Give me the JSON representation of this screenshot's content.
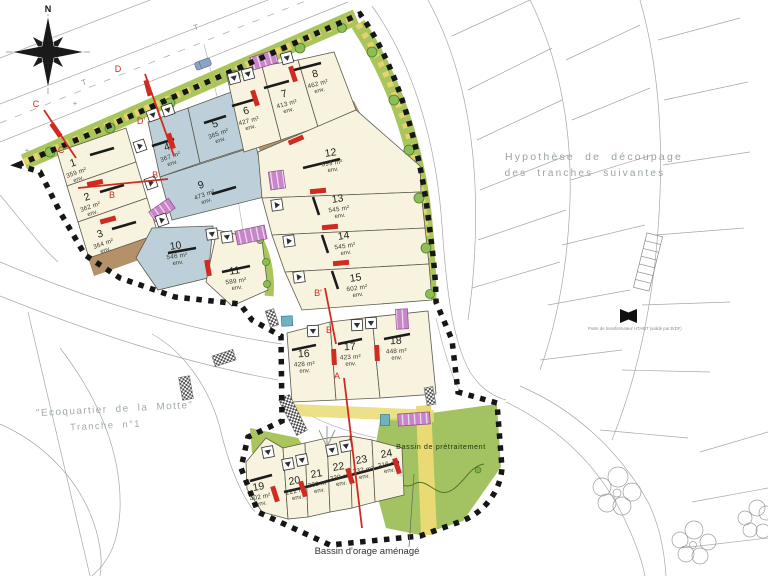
{
  "colors": {
    "c": "#f7f3df",
    "b": "#bdd0da",
    "verge": "#a9c55c",
    "hedge": "#e6d26e",
    "tree": "#8cbe53",
    "tree_stroke": "#517f2c",
    "bassin": "#a3c261",
    "path_yellow": "#e9da74",
    "brown": "#b59169",
    "purple": "#c985c9",
    "red": "#cf2b20",
    "boundary": "#161616",
    "future_gray": "#a7a7a7",
    "gray_label": "#9aa4a2"
  },
  "compass": {
    "label": "N"
  },
  "env_label": "env.",
  "annotations": {
    "hypothese_line1": "Hypothèse de découpage",
    "hypothese_line2": "des tranches suivantes",
    "ecoquartier_line1": "\"Ecoquartier de la Motte\"",
    "ecoquartier_line2": "Tranche n°1",
    "bassin_pretraitement": "Bassin de prétraitement",
    "bassin_orage": "Bassin d'orage aménagé",
    "transformer_note": "Poste de transformateur HTA/BT (validé par ErDF)",
    "utility_t1": "T",
    "utility_t2": "T",
    "cross1": "+",
    "cross2": "+"
  },
  "section_labels": [
    {
      "t": "C",
      "x": 36,
      "y": 107
    },
    {
      "t": "C'",
      "x": 62,
      "y": 153
    },
    {
      "t": "D",
      "x": 118,
      "y": 72
    },
    {
      "t": "D'",
      "x": 141,
      "y": 124
    },
    {
      "t": "B",
      "x": 112,
      "y": 198
    },
    {
      "t": "B'",
      "x": 156,
      "y": 178
    },
    {
      "t": "B'",
      "x": 318,
      "y": 296
    },
    {
      "t": "B",
      "x": 329,
      "y": 333
    },
    {
      "t": "A",
      "x": 337,
      "y": 379
    }
  ],
  "lots": [
    {
      "num": "1",
      "area": "359 m²",
      "type": "c",
      "poly": "57,152 126,128 136,162 67,186",
      "cx": 74,
      "cy": 166,
      "rot": -19,
      "bar": [
        90,
        155,
        114,
        148
      ]
    },
    {
      "num": "2",
      "area": "362 m²",
      "type": "c",
      "poly": "67,186 136,162 147,198 78,222",
      "cx": 88,
      "cy": 200,
      "rot": -19,
      "bar": [
        100,
        192,
        124,
        185
      ]
    },
    {
      "num": "3",
      "area": "364 m²",
      "type": "c",
      "poly": "78,222 147,198 158,234 89,258",
      "cx": 101,
      "cy": 237,
      "rot": -19,
      "bar": [
        112,
        229,
        136,
        222
      ]
    },
    {
      "num": "4",
      "area": "367 m²",
      "type": "b",
      "poly": "148,122 188,108 200,163 160,177",
      "cx": 168,
      "cy": 150,
      "rot": -19,
      "bar": [
        152,
        146,
        174,
        139
      ]
    },
    {
      "num": "5",
      "area": "365 m²",
      "type": "b",
      "poly": "188,108 242,88 256,145 200,163",
      "cx": 216,
      "cy": 127,
      "rot": -19,
      "bar": [
        204,
        123,
        226,
        116
      ]
    },
    {
      "num": "9",
      "area": "473 m²",
      "type": "b",
      "poly": "160,177 256,146 268,196 172,220",
      "cx": 202,
      "cy": 188,
      "rot": -19,
      "bar": [
        212,
        194,
        236,
        187
      ]
    },
    {
      "num": "10",
      "area": "546 m²",
      "type": "b",
      "poly": "152,228 213,226 208,278 158,290 136,258",
      "cx": 176,
      "cy": 249,
      "rot": -8,
      "bar": [
        168,
        253,
        196,
        248
      ]
    },
    {
      "num": "11",
      "area": "589 m²",
      "type": "c",
      "poly": "217,230 262,240 268,290 232,306 206,282",
      "cx": 235,
      "cy": 274,
      "rot": -8,
      "bar": [
        222,
        272,
        250,
        266
      ]
    },
    {
      "num": "6",
      "area": "427 m²",
      "type": "c",
      "poly": "226,72 262,66 281,140 244,152",
      "cx": 247,
      "cy": 114,
      "rot": -15,
      "bar": [
        232,
        106,
        256,
        99
      ]
    },
    {
      "num": "7",
      "area": "413 m²",
      "type": "c",
      "poly": "262,66 298,60 318,127 281,140",
      "cx": 285,
      "cy": 97,
      "rot": -15,
      "bar": [
        264,
        88,
        289,
        81
      ]
    },
    {
      "num": "8",
      "area": "462 m²",
      "type": "c",
      "poly": "298,60 334,52 356,110 318,127",
      "cx": 316,
      "cy": 77,
      "rot": -15,
      "bar": [
        294,
        70,
        321,
        63
      ]
    },
    {
      "num": "12",
      "area": "599 m²",
      "type": "c",
      "poly": "258,152 356,110 420,166 421,192 262,198",
      "cx": 331,
      "cy": 156,
      "rot": -8,
      "bar": [
        303,
        168,
        340,
        159
      ]
    },
    {
      "num": "13",
      "area": "545 m²",
      "type": "c",
      "poly": "262,198 421,192 425,228 272,235",
      "cx": 338,
      "cy": 202,
      "rot": -8,
      "bar": [
        313,
        197,
        319,
        215
      ]
    },
    {
      "num": "14",
      "area": "545 m²",
      "type": "c",
      "poly": "272,235 425,228 429,264 285,272",
      "cx": 344,
      "cy": 239,
      "rot": -8,
      "bar": [
        322,
        235,
        328,
        253
      ]
    },
    {
      "num": "15",
      "area": "602 m²",
      "type": "c",
      "poly": "285,272 429,264 432,300 302,310",
      "cx": 356,
      "cy": 281,
      "rot": -8,
      "bar": [
        332,
        271,
        338,
        289
      ]
    },
    {
      "num": "16",
      "area": "428 m²",
      "type": "c",
      "poly": "287,333 330,322 336,400 292,402",
      "cx": 304,
      "cy": 357,
      "rot": -3,
      "bar": [
        292,
        350,
        316,
        345
      ]
    },
    {
      "num": "17",
      "area": "423 m²",
      "type": "c",
      "poly": "330,322 372,317 380,398 336,400",
      "cx": 350,
      "cy": 350,
      "rot": -3,
      "bar": [
        338,
        344,
        362,
        339
      ]
    },
    {
      "num": "18",
      "area": "448 m²",
      "type": "c",
      "poly": "372,317 428,311 436,394 380,398",
      "cx": 396,
      "cy": 344,
      "rot": -3,
      "bar": [
        384,
        339,
        410,
        334
      ]
    },
    {
      "num": "19",
      "area": "402 m²",
      "type": "c",
      "poly": "246,462 266,438 283,448 288,519 262,512 247,489",
      "cx": 259,
      "cy": 490,
      "rot": -10,
      "bar": [
        250,
        481,
        272,
        475
      ]
    },
    {
      "num": "20",
      "area": "222 m²",
      "type": "c",
      "poly": "283,448 305,443 308,517 288,519",
      "cx": 295,
      "cy": 484,
      "rot": -10,
      "bar": [
        284,
        492,
        306,
        487
      ]
    },
    {
      "num": "21",
      "area": "230 m²",
      "type": "c",
      "poly": "305,443 327,438 330,512 308,517",
      "cx": 317,
      "cy": 477,
      "rot": -10,
      "bar": [
        306,
        487,
        328,
        481
      ]
    },
    {
      "num": "22",
      "area": "230 m²",
      "type": "c",
      "poly": "327,438 350,436 352,508 330,512",
      "cx": 339,
      "cy": 470,
      "rot": -10,
      "bar": [
        328,
        481,
        351,
        475
      ]
    },
    {
      "num": "23",
      "area": "232 m²",
      "type": "c",
      "poly": "350,436 372,440 375,502 352,508",
      "cx": 362,
      "cy": 463,
      "rot": -10,
      "bar": [
        351,
        475,
        374,
        469
      ]
    },
    {
      "num": "24",
      "area": "316 m²",
      "type": "c",
      "poly": "372,440 402,448 404,495 375,502",
      "cx": 387,
      "cy": 457,
      "rot": -10,
      "bar": [
        374,
        469,
        399,
        462
      ]
    }
  ],
  "markers": [
    {
      "x": 140,
      "y": 146,
      "rot": -19,
      "dir": "right"
    },
    {
      "x": 151,
      "y": 183,
      "rot": -19,
      "dir": "right"
    },
    {
      "x": 162,
      "y": 220,
      "rot": -19,
      "dir": "right"
    },
    {
      "x": 153,
      "y": 115,
      "rot": -19,
      "dir": "down"
    },
    {
      "x": 168,
      "y": 110,
      "rot": -19,
      "dir": "down"
    },
    {
      "x": 212,
      "y": 234,
      "rot": -8,
      "dir": "down"
    },
    {
      "x": 227,
      "y": 237,
      "rot": -8,
      "dir": "down"
    },
    {
      "x": 234,
      "y": 78,
      "rot": -15,
      "dir": "down"
    },
    {
      "x": 248,
      "y": 74,
      "rot": -15,
      "dir": "down"
    },
    {
      "x": 287,
      "y": 58,
      "rot": -15,
      "dir": "down"
    },
    {
      "x": 277,
      "y": 205,
      "rot": -8,
      "dir": "right"
    },
    {
      "x": 289,
      "y": 241,
      "rot": -8,
      "dir": "right"
    },
    {
      "x": 299,
      "y": 277,
      "rot": -8,
      "dir": "right"
    },
    {
      "x": 313,
      "y": 331,
      "rot": -3,
      "dir": "down"
    },
    {
      "x": 357,
      "y": 325,
      "rot": -3,
      "dir": "down"
    },
    {
      "x": 371,
      "y": 323,
      "rot": -3,
      "dir": "down"
    },
    {
      "x": 268,
      "y": 452,
      "rot": -10,
      "dir": "down"
    },
    {
      "x": 288,
      "y": 464,
      "rot": -10,
      "dir": "down"
    },
    {
      "x": 302,
      "y": 460,
      "rot": -10,
      "dir": "down"
    },
    {
      "x": 332,
      "y": 450,
      "rot": -10,
      "dir": "down"
    },
    {
      "x": 346,
      "y": 446,
      "rot": -10,
      "dir": "down"
    }
  ],
  "red_bars": [
    {
      "x": 56,
      "y": 130,
      "rot": 55
    },
    {
      "x": 148,
      "y": 88,
      "rot": 75
    },
    {
      "x": 171,
      "y": 141,
      "rot": 72
    },
    {
      "x": 95,
      "y": 183,
      "rot": -12
    },
    {
      "x": 108,
      "y": 220,
      "rot": -15
    },
    {
      "x": 255,
      "y": 98,
      "rot": 72
    },
    {
      "x": 293,
      "y": 74,
      "rot": 72
    },
    {
      "x": 296,
      "y": 140,
      "rot": -23
    },
    {
      "x": 318,
      "y": 191,
      "rot": -5
    },
    {
      "x": 330,
      "y": 227,
      "rot": -5
    },
    {
      "x": 341,
      "y": 263,
      "rot": -5
    },
    {
      "x": 208,
      "y": 268,
      "rot": 80
    },
    {
      "x": 334,
      "y": 357,
      "rot": 87
    },
    {
      "x": 377,
      "y": 353,
      "rot": 87
    },
    {
      "x": 275,
      "y": 494,
      "rot": 72
    },
    {
      "x": 303,
      "y": 489,
      "rot": 72
    },
    {
      "x": 350,
      "y": 476,
      "rot": 72
    },
    {
      "x": 397,
      "y": 466,
      "rot": 72
    }
  ]
}
